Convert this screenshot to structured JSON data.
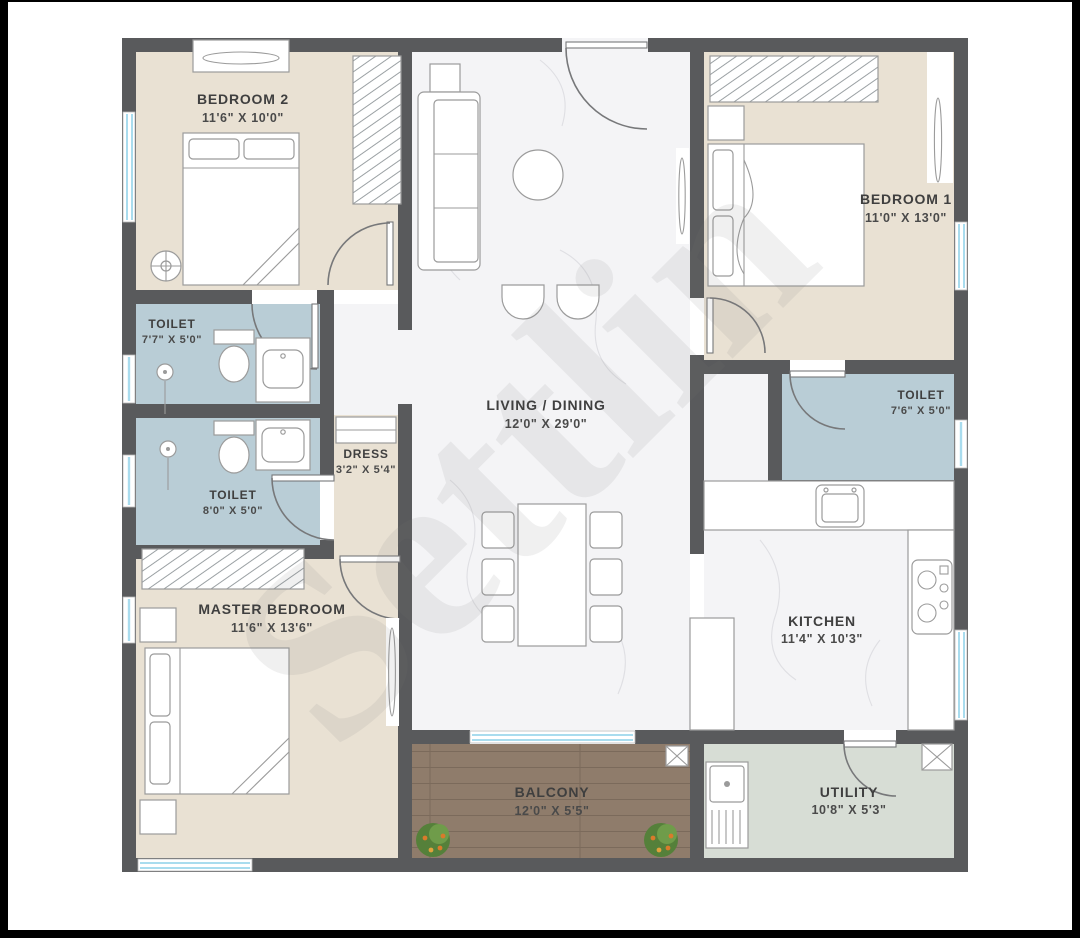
{
  "watermark": {
    "text": "Settlin"
  },
  "palette": {
    "wall": "#595a5c",
    "bedroom_floor": "#e9e1d3",
    "toilet_floor": "#b9cdd6",
    "marble_floor": "#f4f4f6",
    "balcony_wood": "#8f7c6b",
    "utility_floor": "#d7ddd5",
    "window_blue": "#a9dcee",
    "label_text": "#3f3f3f"
  },
  "rooms": {
    "bedroom2": {
      "name": "BEDROOM 2",
      "dims": "11'6\" X 10'0\""
    },
    "toilet1": {
      "name": "TOILET",
      "dims": "7'7\" X 5'0\""
    },
    "toilet2": {
      "name": "TOILET",
      "dims": "8'0\" X 5'0\""
    },
    "dress": {
      "name": "DRESS",
      "dims": "3'2\" X 5'4\""
    },
    "master_bedroom": {
      "name": "MASTER BEDROOM",
      "dims": "11'6\" X 13'6\""
    },
    "living_dining": {
      "name": "LIVING / DINING",
      "dims": "12'0\" X 29'0\""
    },
    "bedroom1": {
      "name": "BEDROOM 1",
      "dims": "11'0\" X 13'0\""
    },
    "toilet3": {
      "name": "TOILET",
      "dims": "7'6\" X 5'0\""
    },
    "kitchen": {
      "name": "KITCHEN",
      "dims": "11'4\" X 10'3\""
    },
    "balcony": {
      "name": "BALCONY",
      "dims": "12'0\" X 5'5\""
    },
    "utility": {
      "name": "UTILITY",
      "dims": "10'8\" X 5'3\""
    }
  }
}
